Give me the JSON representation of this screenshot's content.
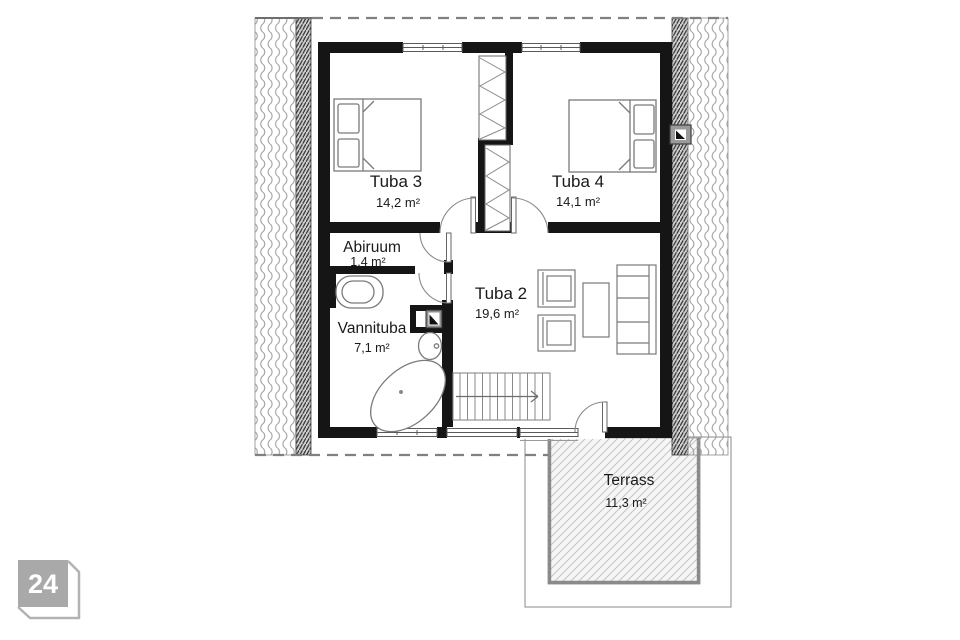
{
  "plan": {
    "rooms": [
      {
        "name": "Tuba 3",
        "area": "14,2 m²"
      },
      {
        "name": "Tuba 4",
        "area": "14,1 m²"
      },
      {
        "name": "Abiruum",
        "area": "1,4 m²"
      },
      {
        "name": "Tuba 2",
        "area": "19,6 m²"
      },
      {
        "name": "Vannituba",
        "area": "7,1 m²"
      },
      {
        "name": "Terrass",
        "area": "11,3 m²"
      }
    ],
    "colors": {
      "wall": "#151515",
      "furniture_line": "#7a7a7a",
      "hatch_line": "#9e9e9e",
      "dashed_line": "#808080",
      "text": "#1a1a1a",
      "badge": "#a9a9a9"
    }
  },
  "badge": {
    "number": "24"
  }
}
